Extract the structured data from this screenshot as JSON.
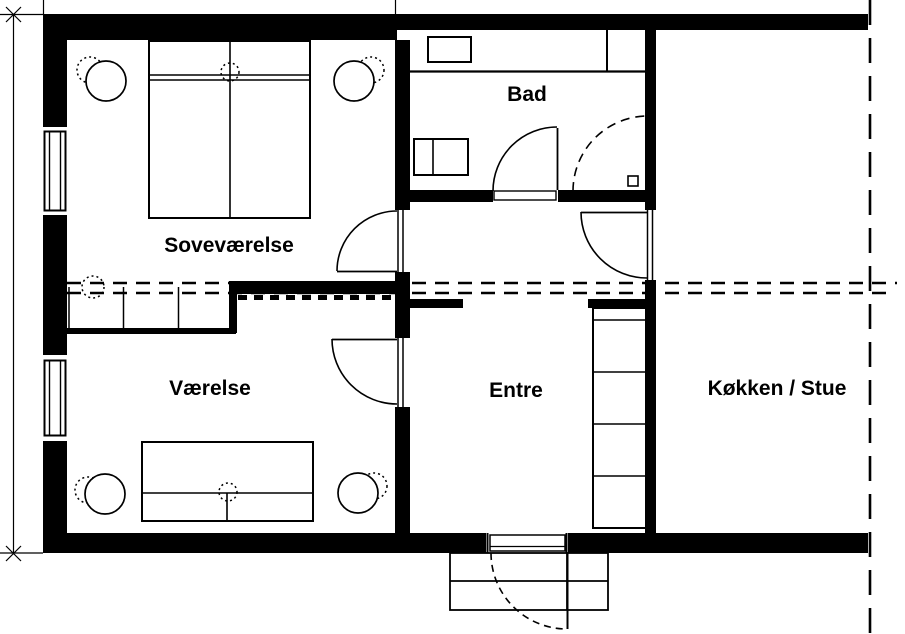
{
  "drawing": {
    "type": "floor-plan",
    "colors": {
      "ink": "#000000",
      "paper": "#ffffff"
    },
    "rooms": {
      "sovevaerelse": {
        "label": "Soveværelse"
      },
      "bad": {
        "label": "Bad"
      },
      "vaerelse": {
        "label": "Værelse"
      },
      "entre": {
        "label": "Entre"
      },
      "koekken_stue": {
        "label": "Køkken / Stue"
      }
    }
  }
}
